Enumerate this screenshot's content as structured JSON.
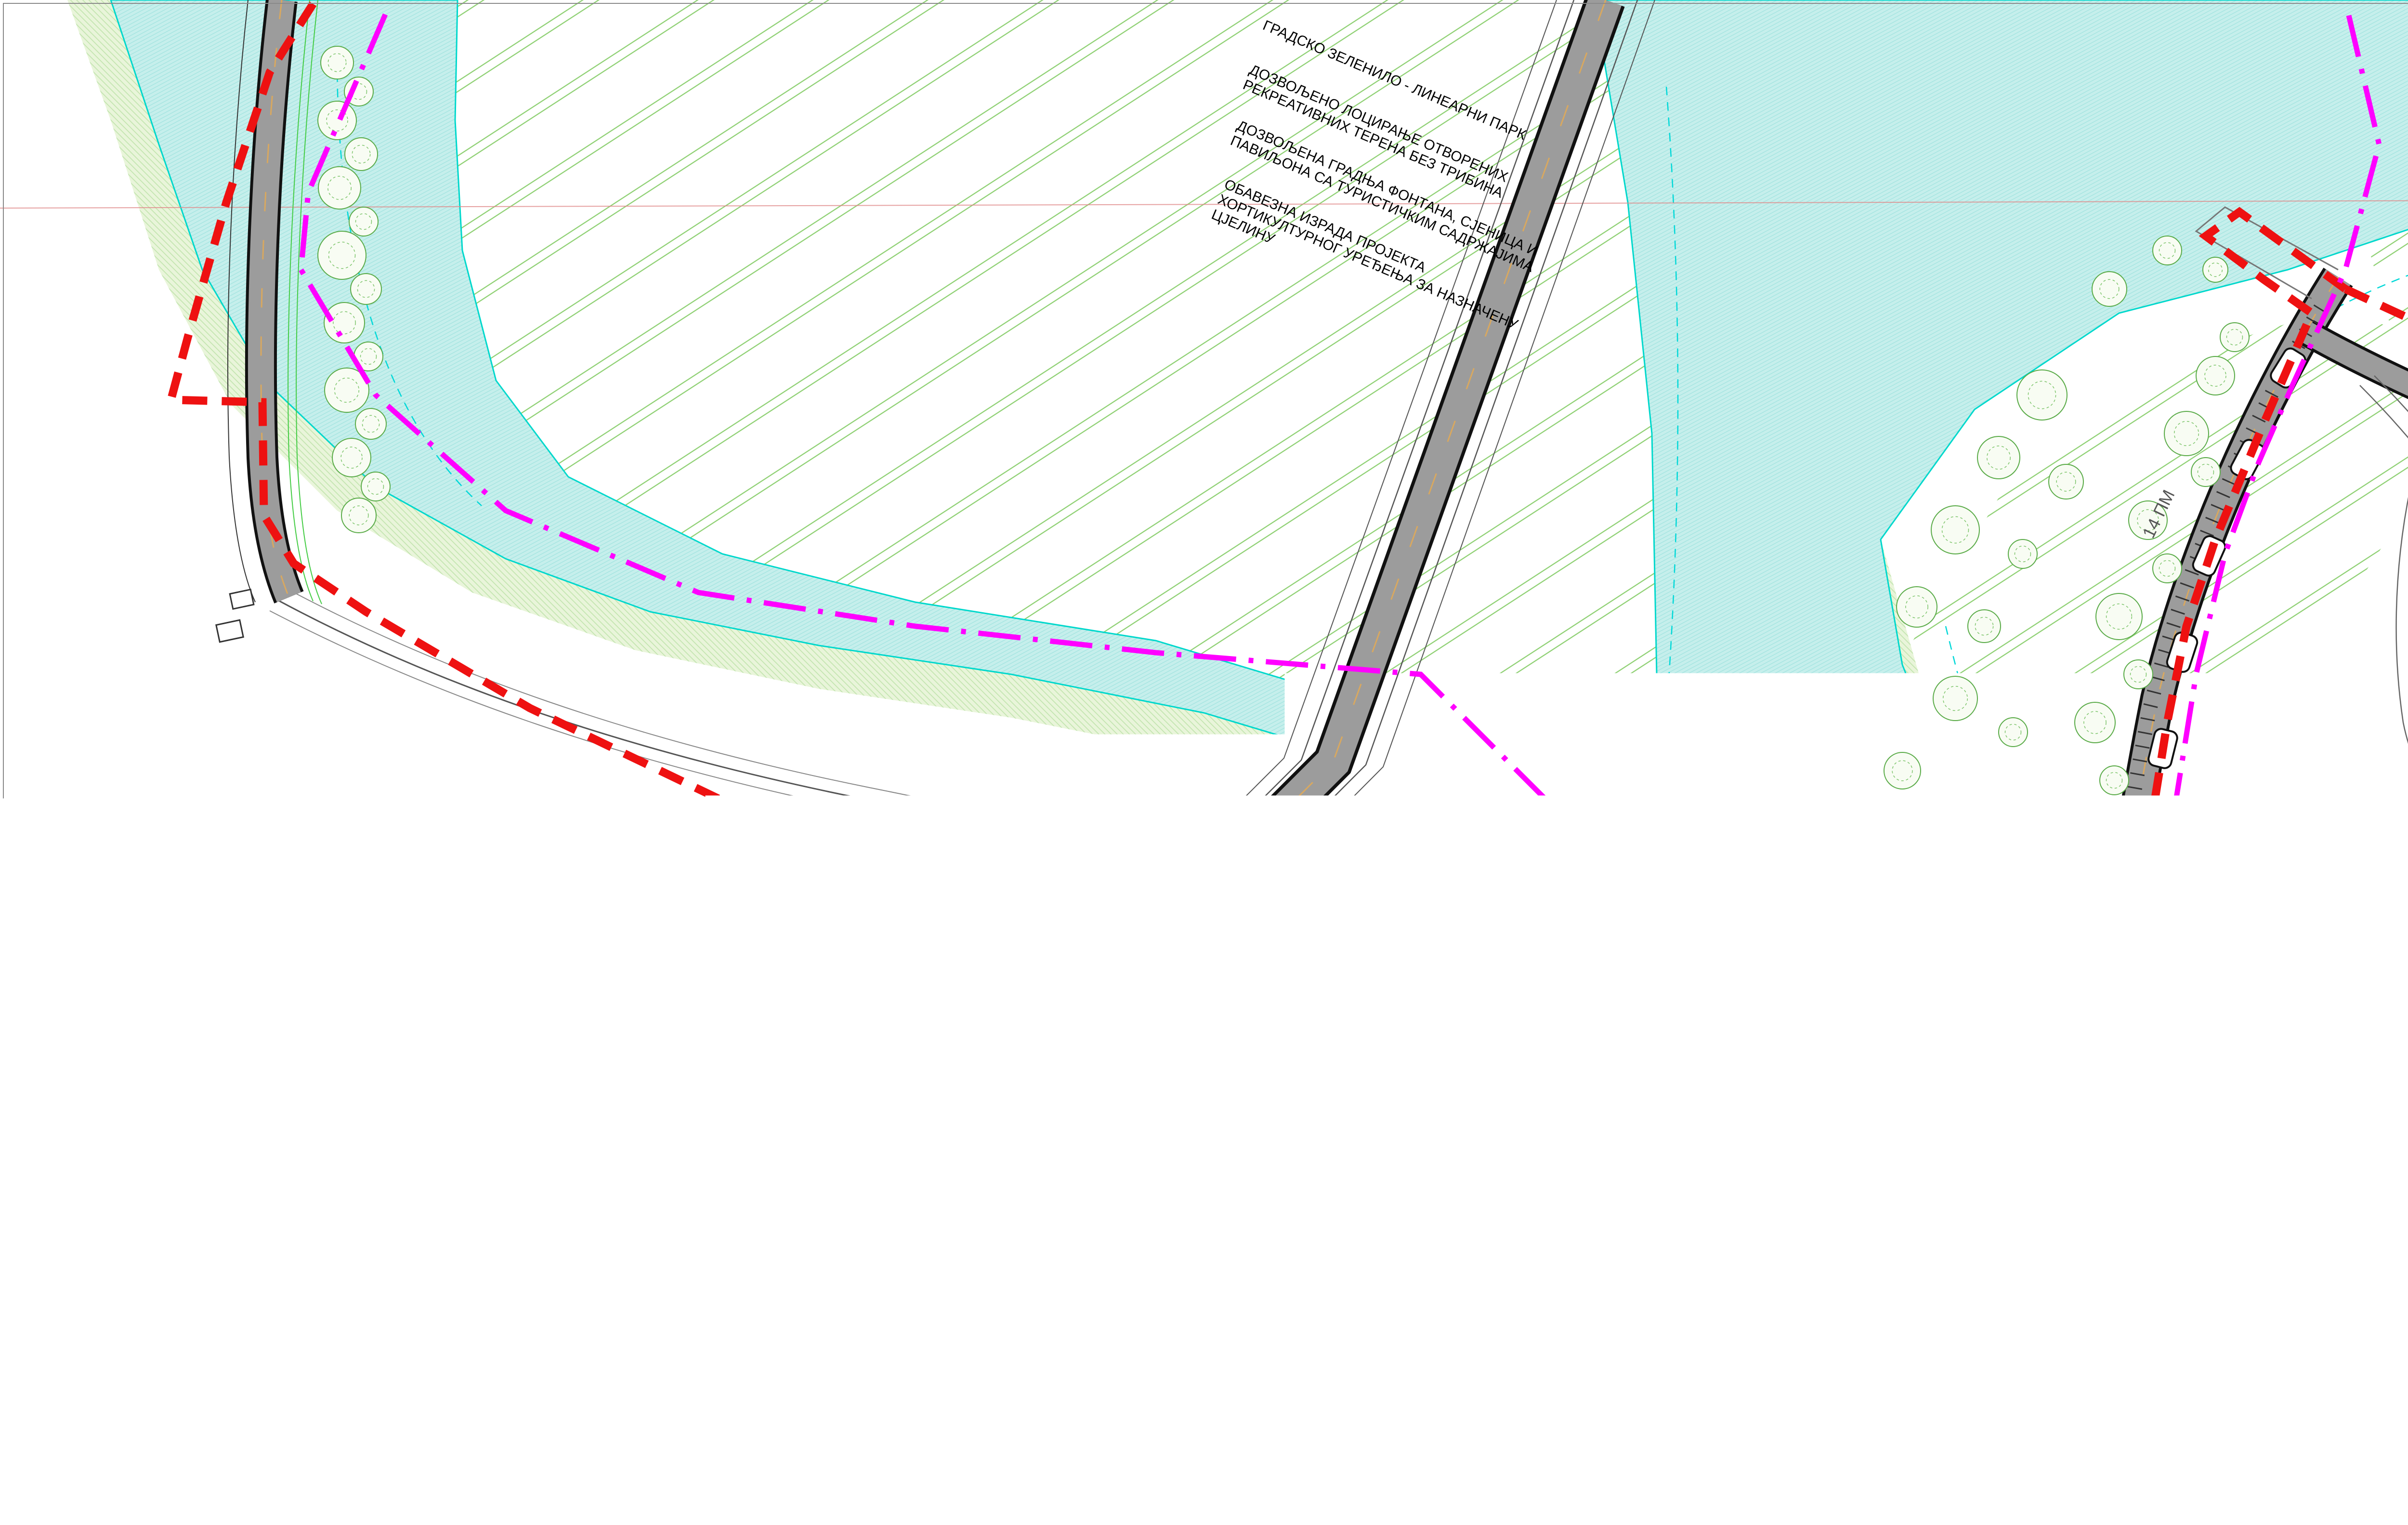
{
  "map": {
    "annotations": [
      {
        "lines": [
          "ГРАДСКО ЗЕЛЕНИЛО - ЛИНЕАРНИ ПАРК"
        ]
      },
      {
        "lines": [
          "ДОЗВОЉЕНО ЛОЦИРАЊЕ ОТВОРЕНИХ",
          "РЕКРЕАТИВНИХ ТЕРЕНА БЕЗ ТРИБИНА"
        ]
      },
      {
        "lines": [
          "ДОЗВОЉЕНА ГРАДЊА ФОНТАНА, СЈЕНИЦА И",
          "ПАВИЉОНА СА ТУРИСТИЧКИМ САДРЖАЈИМА"
        ]
      },
      {
        "lines": [
          "ОБАВЕЗНА ИЗРАДА ПРОЈЕКТА",
          "ХОРТИКУЛТУРНОГ УРЕЂЕЊА ЗА НАЗНАЧЕНУ",
          "ЦЈЕЛИНУ"
        ]
      }
    ],
    "labels": {
      "sheet_number": "8",
      "parking": "14 ПМ"
    }
  },
  "panel": {
    "title_lines": [
      "РЕГУЛАЦИОНИ ПЛАН ЗА УРЕЂЕЊЕ",
      "ОБАЛА ВРБАСА У БАЊАЛУЦИ"
    ],
    "subtitle_lines": [
      "ПЛАН ПРОСТОРНЕ ОРГАНИЗАЦИЈЕ",
      "И УРЕЂЕЊА ЗЕЛЕНИЛА"
    ],
    "legend_label": "LEGENDA:",
    "wind_rose": {
      "directions": [
        "N",
        "NE",
        "E",
        "SE",
        "S",
        "SW",
        "W",
        "NW"
      ],
      "rings": [
        5,
        10,
        15,
        20
      ],
      "center": "29",
      "values": [
        19,
        17,
        7,
        6,
        9,
        7,
        8,
        5
      ]
    },
    "legend_left": [
      {
        "label": "ПОСТОЈЕЋИ ОБЈЕКТИ"
      },
      {
        "label": "ПЛАНИРАНИ ОБЈЕКТИ"
      },
      {
        "label": "ГРАНИЦА ОБУХВАТА"
      },
      {
        "label": "СТАМБЕНИ ОБЈЕКТИ"
      },
      {
        "label": "СТАМБЕНО-ПОСЛОВНИ ОБЈЕКТИ"
      },
      {
        "label": "ПОСЛОВНИ ОБЈЕКТИ"
      },
      {
        "label": "ВЈЕРСКИ ОБЈЕКТИ"
      },
      {
        "label": "ОБЈЕКТИ ЦЕНТРАЛНИХ ДЈЕЛАТНОСТИ"
      },
      {
        "label": "ПОСЛОВНО-ПРОИЗВОДНИ ОБЈЕКТИ"
      },
      {
        "label": "ВИКЕНД КУЋЕ"
      },
      {
        "label": "СПОРТСКИ ОБЈЕКТИ"
      },
      {
        "label": "ОБЈЕКТИ КУЛТУРЕ"
      },
      {
        "label": "ОБЈЕКТИ ТУРИСТИЧКИХ ДЈЕЛАТНОСТИ"
      },
      {
        "label": "ВОДЕНЕ ПОВРШИНЕ"
      },
      {
        "label": "ЗОНА ЗА ИЗГРАДЊУ ХИДРОЕЛЕКТРАНА"
      },
      {
        "label": "ВОДЕНЕ ПОВРШИНЕ ПОД КОТОМ УСПОРА"
      },
      {
        "label": "СПОРТСКИ ТЕРЕНИ"
      },
      {
        "label": "ГРОБЉА"
      },
      {
        "label": "ФАБРИКА ВОДЕ"
      },
      {
        "label": "ЗОО ВРТ"
      },
      {
        "label": "ПОВРШИНА РЕЗЕРВИСАНА ЗА ПРЕЧИСТАЧ ОТПАДНИХ ВОДА"
      },
      {
        "label": "ГРАНИЦА ОБУХВАТА ДЕТАЉНИХ ИДЕЈНИХ ПРОЈЕКАТА"
      },
      {
        "label": "ГРАНИЦА ПАРЦЕЛЕ ОБЈЕКАТА"
      },
      {
        "label": "СПРАТНОСТ ОБЈЕКАТА",
        "symbol": "П+1"
      }
    ],
    "legend_right": [
      {
        "label": "ЈАВНЕ ЗЕЛЕНЕ ПОВРШИНЕ"
      },
      {
        "label": "ПЛАНИРАНИ ПАРК"
      },
      {
        "label": "ОБАЛНА ВЕГЕТАЦИЈА"
      },
      {
        "label": "ПОЉОПРИВРЕДНО ЗЕМЉИШТЕ"
      },
      {
        "label": "ЗАШТИЋЕНИ БОТАНИЧКИ ЛОКАЛИТЕТИ"
      },
      {
        "label": "ЗЕЛЕНИЛО ПРИВАТНИХ ДВОРИШТА"
      },
      {
        "label": "ПОПЛОЧАЊЕ"
      },
      {
        "label": "ДЕНДРОФОНД"
      },
      {
        "label": "ПОСТОЈЕЋИ ВРИЈЕДНИ ПОЈЕДИНАЧНИ ПРИМЈЕРЦИ ДЕНДРОФЛОРЕ"
      }
    ],
    "titleblock": {
      "client_label": "Наручилац:",
      "client": "Град Бањалука",
      "preparer_label": "Носилац припреме:",
      "preparer_line1": "Град Бањалука",
      "preparer_line2": "Одјељење за просторно уређење",
      "maker_label": "Носилац израде:",
      "company_top": "акционарско друштво",
      "company_name": "ПРОЈЕКТ",
      "company_city": "БАЊА ЛУКА",
      "team_lead": "Руководилац радног тима:  Невена Предојевић,  дипл.инж.арх.",
      "designer": "Одговорни пројектант и планер: Невена Предојевић,  дипл.инж.арх.",
      "drawing": "Израда прилога: Невена Предојевић,  дипл.инж.арх.",
      "collaborators": "Сарадници: Мр. Борис Марковић,  дипл.инж.шум.",
      "director_label": "Директор:",
      "director": "Мр Мирослав Вујатовић , дипл.инж.саоб.",
      "date": "Датум: јун 2010. г.",
      "project_no": "Број пројекта: 99/08",
      "scale": "Размјера -  1:1000",
      "sheet_no": "Редни број прилога 5.8"
    }
  },
  "colors": {
    "boundary": "#ee1111",
    "detail_boundary": "#ff00ff",
    "water": "#c6efec",
    "road": "#9c9c9c",
    "parcel_line": "#ff8c00",
    "field_hatch": "#8ccf70",
    "wind_rose_fill": "#5b5fae"
  }
}
